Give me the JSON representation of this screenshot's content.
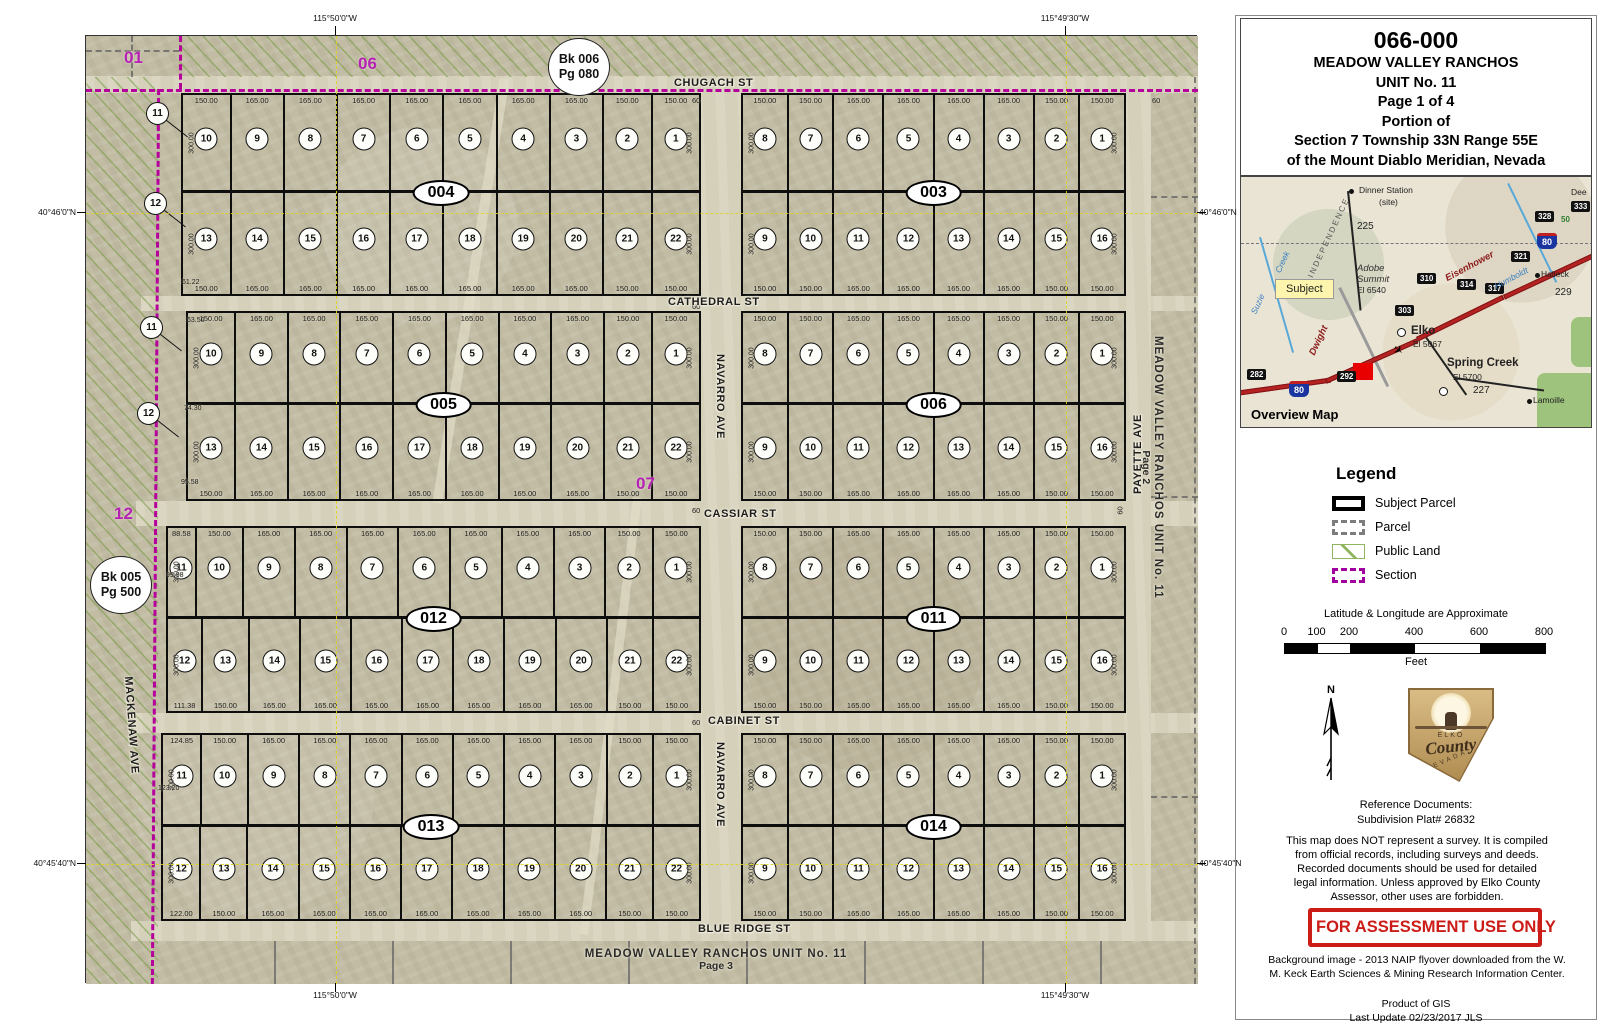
{
  "panel": {
    "title": {
      "apn": "066-000",
      "l1": "MEADOW VALLEY RANCHOS",
      "l2": "UNIT No. 11",
      "l3": "Page 1 of 4",
      "l4": "Portion of",
      "l5": "Section 7 Township 33N  Range 55E",
      "l6": "of the Mount Diablo Meridian, Nevada"
    },
    "overview": {
      "labels": [
        {
          "t": "Dinner Station",
          "x": 118,
          "y": 8,
          "cls": "sm"
        },
        {
          "t": "(site)",
          "x": 138,
          "y": 20,
          "cls": "sm"
        },
        {
          "t": "225",
          "x": 116,
          "y": 44,
          "cls": "hwy"
        },
        {
          "t": "Dee",
          "x": 330,
          "y": 10,
          "cls": "sm"
        },
        {
          "t": "333",
          "x": 330,
          "y": 24,
          "cls": "shield"
        },
        {
          "t": "328",
          "x": 294,
          "y": 34,
          "cls": "shield"
        },
        {
          "t": "50",
          "x": 320,
          "y": 38,
          "cls": "green-sm"
        },
        {
          "t": "80",
          "x": 296,
          "y": 56,
          "cls": "i80"
        },
        {
          "t": "321",
          "x": 270,
          "y": 74,
          "cls": "shield"
        },
        {
          "t": "Halleck",
          "x": 300,
          "y": 92,
          "cls": "sm"
        },
        {
          "t": "229",
          "x": 314,
          "y": 110,
          "cls": "hwy"
        },
        {
          "t": "INDEPENDENCE",
          "x": 44,
          "y": 56,
          "cls": "range rot"
        },
        {
          "t": "Suzie",
          "x": 6,
          "y": 122,
          "cls": "river rot"
        },
        {
          "t": "Creek",
          "x": 30,
          "y": 80,
          "cls": "river rot"
        },
        {
          "t": "Adobe",
          "x": 116,
          "y": 86,
          "cls": "it"
        },
        {
          "t": "Summit",
          "x": 116,
          "y": 97,
          "cls": "it"
        },
        {
          "t": "El 6540",
          "x": 116,
          "y": 108,
          "cls": "sm"
        },
        {
          "t": "310",
          "x": 176,
          "y": 96,
          "cls": "shield"
        },
        {
          "t": "Eisenhower",
          "x": 202,
          "y": 84,
          "cls": "road-name rot2"
        },
        {
          "t": "314",
          "x": 216,
          "y": 102,
          "cls": "shield"
        },
        {
          "t": "317",
          "x": 244,
          "y": 106,
          "cls": "shield"
        },
        {
          "t": "Humboldt",
          "x": 252,
          "y": 96,
          "cls": "river rot2"
        },
        {
          "t": "303",
          "x": 154,
          "y": 128,
          "cls": "shield"
        },
        {
          "t": "Subject",
          "x": 34,
          "y": 102,
          "cls": "subject"
        },
        {
          "t": "Dwight",
          "x": 62,
          "y": 158,
          "cls": "road-name rot"
        },
        {
          "t": "Elko",
          "x": 170,
          "y": 148,
          "cls": "city"
        },
        {
          "t": "El 5067",
          "x": 172,
          "y": 162,
          "cls": "sm"
        },
        {
          "t": "Spring Creek",
          "x": 206,
          "y": 180,
          "cls": "city"
        },
        {
          "t": "El 5700",
          "x": 212,
          "y": 195,
          "cls": "sm"
        },
        {
          "t": "227",
          "x": 232,
          "y": 208,
          "cls": "hwy"
        },
        {
          "t": "Lamoille",
          "x": 292,
          "y": 218,
          "cls": "sm"
        },
        {
          "t": "282",
          "x": 6,
          "y": 192,
          "cls": "shield"
        },
        {
          "t": "80",
          "x": 48,
          "y": 204,
          "cls": "i80"
        },
        {
          "t": "292",
          "x": 96,
          "y": 194,
          "cls": "shield"
        },
        {
          "t": "Overview Map",
          "x": 10,
          "y": 230,
          "cls": "ov-title"
        }
      ]
    },
    "legend": {
      "title": "Legend",
      "items": [
        {
          "label": "Subject Parcel",
          "swatch": "subject"
        },
        {
          "label": "Parcel",
          "swatch": "parcel"
        },
        {
          "label": "Public Land",
          "swatch": "public"
        },
        {
          "label": "Section",
          "swatch": "section"
        }
      ]
    },
    "scale": {
      "note": "Latitude & Longitude are Approximate",
      "unit": "Feet",
      "ticks": [
        {
          "t": "0",
          "f": 0
        },
        {
          "t": "100",
          "f": 0.125
        },
        {
          "t": "200",
          "f": 0.25
        },
        {
          "t": "400",
          "f": 0.5
        },
        {
          "t": "600",
          "f": 0.75
        },
        {
          "t": "800",
          "f": 1
        }
      ],
      "segments": [
        {
          "f": 1,
          "c": "#000"
        },
        {
          "f": 1,
          "c": "#fff"
        },
        {
          "f": 2,
          "c": "#000"
        },
        {
          "f": 2,
          "c": "#fff"
        },
        {
          "f": 2,
          "c": "#000"
        }
      ]
    },
    "north_label": "N",
    "logo": {
      "top": "ELKO",
      "mid": "County",
      "bottom": "NEVADA"
    },
    "refs": {
      "l1": "Reference Documents:",
      "l2": "Subdivision Plat# 26832"
    },
    "disclaimer": "This map does NOT represent a survey. It is compiled from official records, including surveys and deeds. Recorded documents should be used for detailed legal information. Unless approved by Elko County Assessor, other uses are forbidden.",
    "stamp": "FOR ASSESSMENT USE ONLY",
    "background_note": "Background image - 2013 NAIP flyover downloaded from the W. M. Keck Earth Sciences & Mining Research Information Center.",
    "product": "Product of GIS",
    "updated": "Last Update 02/23/2017 JLS"
  },
  "map": {
    "streets": {
      "chugach": "CHUGACH ST",
      "cathedral": "CATHEDRAL ST",
      "cassiar": "CASSIAR ST",
      "cabinet": "CABINET ST",
      "blue_ridge": "BLUE RIDGE ST",
      "navarro": "NAVARRO AVE",
      "payette": "PAYETTE AVE",
      "mackenaw": "MACKENAW AVE",
      "width_label": "60"
    },
    "page_refs": {
      "right": {
        "l1": "MEADOW VALLEY RANCHOS UNIT No. 11",
        "l2": "Page 2"
      },
      "bottom": {
        "l1": "MEADOW VALLEY RANCHOS UNIT No. 11",
        "l2": "Page 3"
      }
    },
    "section_labels": [
      {
        "t": "01",
        "x": 38,
        "y": 12
      },
      {
        "t": "06",
        "x": 272,
        "y": 18
      },
      {
        "t": "12",
        "x": 28,
        "y": 468
      },
      {
        "t": "07",
        "x": 550,
        "y": 438
      }
    ],
    "book_refs": [
      {
        "l1": "Bk 006",
        "l2": "Pg 080",
        "x": 462,
        "y": 2
      },
      {
        "l1": "Bk 005",
        "l2": "Pg 500",
        "x": 4,
        "y": 520
      }
    ],
    "sliver_lots": [
      {
        "n": "11",
        "x": 60,
        "y": 66
      },
      {
        "n": "12",
        "x": 58,
        "y": 156
      },
      {
        "n": "11",
        "x": 54,
        "y": 280
      },
      {
        "n": "12",
        "x": 51,
        "y": 366
      }
    ],
    "edge_labels": [
      {
        "t": "61.22",
        "x": 96,
        "y": 243
      },
      {
        "t": "63.50",
        "x": 101,
        "y": 281
      },
      {
        "t": "74.30",
        "x": 98,
        "y": 369
      },
      {
        "t": "95.58",
        "x": 95,
        "y": 443
      },
      {
        "t": "99.98",
        "x": 80,
        "y": 536
      },
      {
        "t": "123.20",
        "x": 72,
        "y": 749
      }
    ],
    "width_labels": [
      {
        "x": 606,
        "y": 60
      },
      {
        "x": 1066,
        "y": 60
      },
      {
        "x": 606,
        "y": 266
      },
      {
        "x": 606,
        "y": 470
      },
      {
        "x": 606,
        "y": 682
      },
      {
        "x": 1030,
        "y": 470,
        "rot": 1
      }
    ],
    "graticule": {
      "lon": [
        {
          "label": "115°50'0\"W",
          "x": 335
        },
        {
          "label": "115°49'30\"W",
          "x": 1065
        }
      ],
      "lat": [
        {
          "label": "40°46'0\"N",
          "y": 212
        },
        {
          "label": "40°45'40\"N",
          "y": 863
        }
      ]
    },
    "blocks": [
      {
        "label": "004",
        "x": 95,
        "y": 57,
        "w": 520,
        "h": 203,
        "split": 98,
        "depth": "300.00",
        "rows": [
          {
            "lots": [
              "10",
              "9",
              "8",
              "7",
              "6",
              "5",
              "4",
              "3",
              "2",
              "1"
            ],
            "dims": [
              "150.00",
              "165.00",
              "165.00",
              "165.00",
              "165.00",
              "165.00",
              "165.00",
              "165.00",
              "150.00",
              "150.00"
            ]
          },
          {
            "lots": [
              "13",
              "14",
              "15",
              "16",
              "17",
              "18",
              "19",
              "20",
              "21",
              "22"
            ],
            "dims": [
              "150.00",
              "165.00",
              "165.00",
              "165.00",
              "165.00",
              "165.00",
              "165.00",
              "165.00",
              "150.00",
              "150.00"
            ]
          }
        ]
      },
      {
        "label": "003",
        "x": 655,
        "y": 57,
        "w": 385,
        "h": 203,
        "split": 98,
        "depth": "300.00",
        "rows": [
          {
            "lots": [
              "8",
              "7",
              "6",
              "5",
              "4",
              "3",
              "2",
              "1"
            ],
            "dims": [
              "150.00",
              "150.00",
              "165.00",
              "165.00",
              "165.00",
              "165.00",
              "150.00",
              "150.00"
            ]
          },
          {
            "lots": [
              "9",
              "10",
              "11",
              "12",
              "13",
              "14",
              "15",
              "16"
            ],
            "dims": [
              "150.00",
              "150.00",
              "165.00",
              "165.00",
              "165.00",
              "165.00",
              "150.00",
              "150.00"
            ]
          }
        ]
      },
      {
        "label": "005",
        "x": 100,
        "y": 275,
        "w": 515,
        "h": 190,
        "split": 92,
        "depth": "300.00",
        "rows": [
          {
            "lots": [
              "10",
              "9",
              "8",
              "7",
              "6",
              "5",
              "4",
              "3",
              "2",
              "1"
            ],
            "dims": [
              "150.00",
              "165.00",
              "165.00",
              "165.00",
              "165.00",
              "165.00",
              "165.00",
              "165.00",
              "150.00",
              "150.00"
            ]
          },
          {
            "lots": [
              "13",
              "14",
              "15",
              "16",
              "17",
              "18",
              "19",
              "20",
              "21",
              "22"
            ],
            "dims": [
              "150.00",
              "165.00",
              "165.00",
              "165.00",
              "165.00",
              "165.00",
              "165.00",
              "165.00",
              "150.00",
              "150.00"
            ]
          }
        ]
      },
      {
        "label": "006",
        "x": 655,
        "y": 275,
        "w": 385,
        "h": 190,
        "split": 92,
        "depth": "300.00",
        "rows": [
          {
            "lots": [
              "8",
              "7",
              "6",
              "5",
              "4",
              "3",
              "2",
              "1"
            ],
            "dims": [
              "150.00",
              "150.00",
              "165.00",
              "165.00",
              "165.00",
              "165.00",
              "150.00",
              "150.00"
            ]
          },
          {
            "lots": [
              "9",
              "10",
              "11",
              "12",
              "13",
              "14",
              "15",
              "16"
            ],
            "dims": [
              "150.00",
              "150.00",
              "165.00",
              "165.00",
              "165.00",
              "165.00",
              "150.00",
              "150.00"
            ]
          }
        ]
      },
      {
        "label": "012",
        "x": 80,
        "y": 490,
        "w": 535,
        "h": 187,
        "split": 91,
        "depth": "300.00",
        "rows": [
          {
            "lots": [
              "11",
              "10",
              "9",
              "8",
              "7",
              "6",
              "5",
              "4",
              "3",
              "2",
              "1"
            ],
            "dims": [
              "88.58",
              "150.00",
              "165.00",
              "165.00",
              "165.00",
              "165.00",
              "165.00",
              "165.00",
              "165.00",
              "150.00",
              "150.00"
            ]
          },
          {
            "lots": [
              "12",
              "13",
              "14",
              "15",
              "16",
              "17",
              "18",
              "19",
              "20",
              "21",
              "22"
            ],
            "dims": [
              "111.38",
              "150.00",
              "165.00",
              "165.00",
              "165.00",
              "165.00",
              "165.00",
              "165.00",
              "165.00",
              "150.00",
              "150.00"
            ]
          }
        ]
      },
      {
        "label": "011",
        "x": 655,
        "y": 490,
        "w": 385,
        "h": 187,
        "split": 91,
        "depth": "300.00",
        "rows": [
          {
            "lots": [
              "8",
              "7",
              "6",
              "5",
              "4",
              "3",
              "2",
              "1"
            ],
            "dims": [
              "150.00",
              "150.00",
              "165.00",
              "165.00",
              "165.00",
              "165.00",
              "150.00",
              "150.00"
            ]
          },
          {
            "lots": [
              "9",
              "10",
              "11",
              "12",
              "13",
              "14",
              "15",
              "16"
            ],
            "dims": [
              "150.00",
              "150.00",
              "165.00",
              "165.00",
              "165.00",
              "165.00",
              "150.00",
              "150.00"
            ]
          }
        ]
      },
      {
        "label": "013",
        "x": 75,
        "y": 697,
        "w": 540,
        "h": 188,
        "split": 92,
        "depth": "300.00",
        "rows": [
          {
            "lots": [
              "11",
              "10",
              "9",
              "8",
              "7",
              "6",
              "5",
              "4",
              "3",
              "2",
              "1"
            ],
            "dims": [
              "124.85",
              "150.00",
              "165.00",
              "165.00",
              "165.00",
              "165.00",
              "165.00",
              "165.00",
              "165.00",
              "150.00",
              "150.00"
            ]
          },
          {
            "lots": [
              "12",
              "13",
              "14",
              "15",
              "16",
              "17",
              "18",
              "19",
              "20",
              "21",
              "22"
            ],
            "dims": [
              "122.00",
              "150.00",
              "165.00",
              "165.00",
              "165.00",
              "165.00",
              "165.00",
              "165.00",
              "165.00",
              "150.00",
              "150.00"
            ]
          }
        ]
      },
      {
        "label": "014",
        "x": 655,
        "y": 697,
        "w": 385,
        "h": 188,
        "split": 92,
        "depth": "300.00",
        "rows": [
          {
            "lots": [
              "8",
              "7",
              "6",
              "5",
              "4",
              "3",
              "2",
              "1"
            ],
            "dims": [
              "150.00",
              "150.00",
              "165.00",
              "165.00",
              "165.00",
              "165.00",
              "150.00",
              "150.00"
            ]
          },
          {
            "lots": [
              "9",
              "10",
              "11",
              "12",
              "13",
              "14",
              "15",
              "16"
            ],
            "dims": [
              "150.00",
              "150.00",
              "165.00",
              "165.00",
              "165.00",
              "165.00",
              "150.00",
              "150.00"
            ]
          }
        ]
      }
    ],
    "colors": {
      "section_line": "#b5009b",
      "public_land_hatch": "#70983a",
      "graticule": "#ded41e",
      "stamp_red": "#cc1c17",
      "subject_marker": "#e80000",
      "interstate_blue": "#1a35a0"
    }
  }
}
